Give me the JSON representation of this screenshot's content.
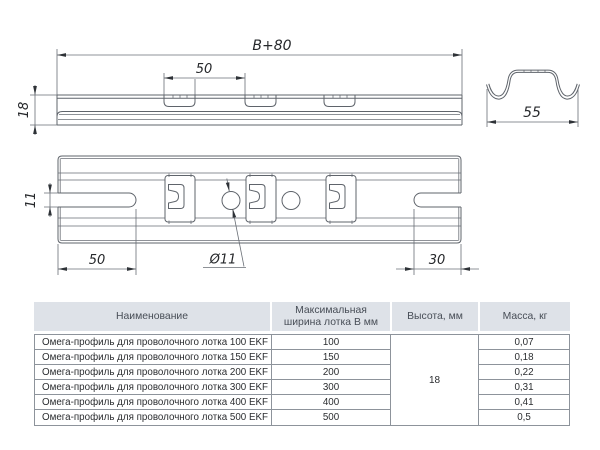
{
  "drawing": {
    "labels": {
      "overall_width": "B+80",
      "tab_spacing": "50",
      "side_height": "18",
      "profile_width": "55",
      "slot_width": "11",
      "hole_diameter": "Ø11",
      "slot_length": "50",
      "end_offset": "30"
    }
  },
  "table": {
    "headers": {
      "name": "Наименование",
      "width_line1": "Максимальная",
      "width_line2": "ширина лотка В мм",
      "height": "Высота, мм",
      "mass": "Масса, кг"
    },
    "merged_height": "18",
    "rows": [
      {
        "name": "Омега-профиль для проволочного лотка 100 EKF",
        "width": "100",
        "mass": "0,07"
      },
      {
        "name": "Омега-профиль для проволочного лотка 150 EKF",
        "width": "150",
        "mass": "0,18"
      },
      {
        "name": "Омега-профиль для проволочного лотка 200 EKF",
        "width": "200",
        "mass": "0,22"
      },
      {
        "name": "Омега-профиль для проволочного лотка 300 EKF",
        "width": "300",
        "mass": "0,31"
      },
      {
        "name": "Омега-профиль для проволочного лотка 400 EKF",
        "width": "400",
        "mass": "0,41"
      },
      {
        "name": "Омега-профиль для проволочного лотка 500 EKF",
        "width": "500",
        "mass": "0,5"
      }
    ]
  },
  "colors": {
    "header_bg": "#dee2e8",
    "table_border": "#8d939b",
    "line": "#5f646b",
    "text": "#2b2d30"
  }
}
